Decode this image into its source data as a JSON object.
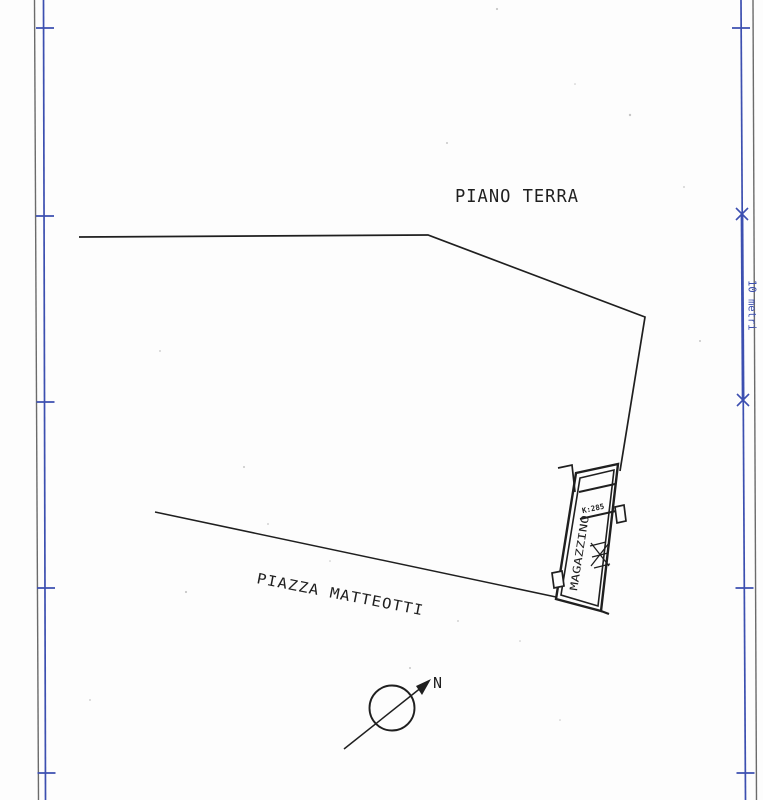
{
  "plan": {
    "title": "PIANO TERRA",
    "street_label": "PIAZZA MATTEOTTI",
    "building_label": "MAGAZZINO",
    "unit_label": "K:285",
    "north_label": "N",
    "scale_label": "10 metri"
  },
  "colors": {
    "ink": "#1f1f1f",
    "frame_blue": "#3c4fb0",
    "frame_gray": "#6b6b6b",
    "paper": "#fdfdfd"
  }
}
